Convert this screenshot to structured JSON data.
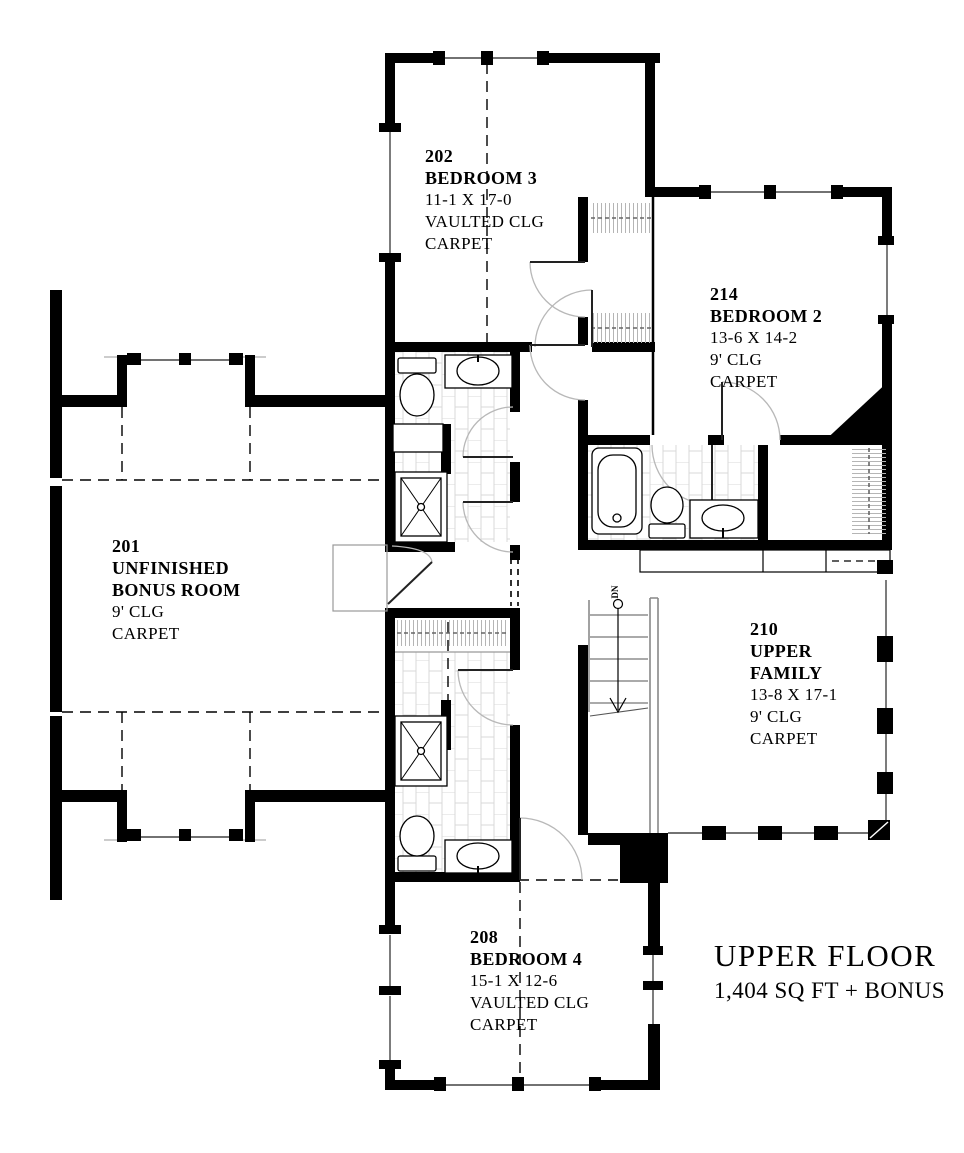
{
  "title": {
    "main": "UPPER FLOOR",
    "sub": "1,404 SQ FT  + BONUS"
  },
  "stairs": {
    "down_label": "DN"
  },
  "rooms": {
    "bedroom3": {
      "number": "202",
      "name": "BEDROOM 3",
      "dimensions": "11-1 X 17-0",
      "ceiling": "VAULTED CLG",
      "floor": "CARPET"
    },
    "bedroom2": {
      "number": "214",
      "name": "BEDROOM 2",
      "dimensions": "13-6 X 14-2",
      "ceiling": "9' CLG",
      "floor": "CARPET"
    },
    "bonus": {
      "number": "201",
      "name_line1": "UNFINISHED",
      "name_line2": "BONUS ROOM",
      "ceiling": "9' CLG",
      "floor": "CARPET"
    },
    "family": {
      "number": "210",
      "name_line1": "UPPER",
      "name_line2": "FAMILY",
      "dimensions": "13-8 X 17-1",
      "ceiling": "9' CLG",
      "floor": "CARPET"
    },
    "bedroom4": {
      "number": "208",
      "name": "BEDROOM 4",
      "dimensions": "15-1 X 12-6",
      "ceiling": "VAULTED CLG",
      "floor": "CARPET"
    }
  },
  "colors": {
    "wall": "#000000",
    "thin_line": "#444444",
    "arc_line": "#b8b8b8",
    "tile_line": "#d9d9d9",
    "background": "#ffffff"
  }
}
